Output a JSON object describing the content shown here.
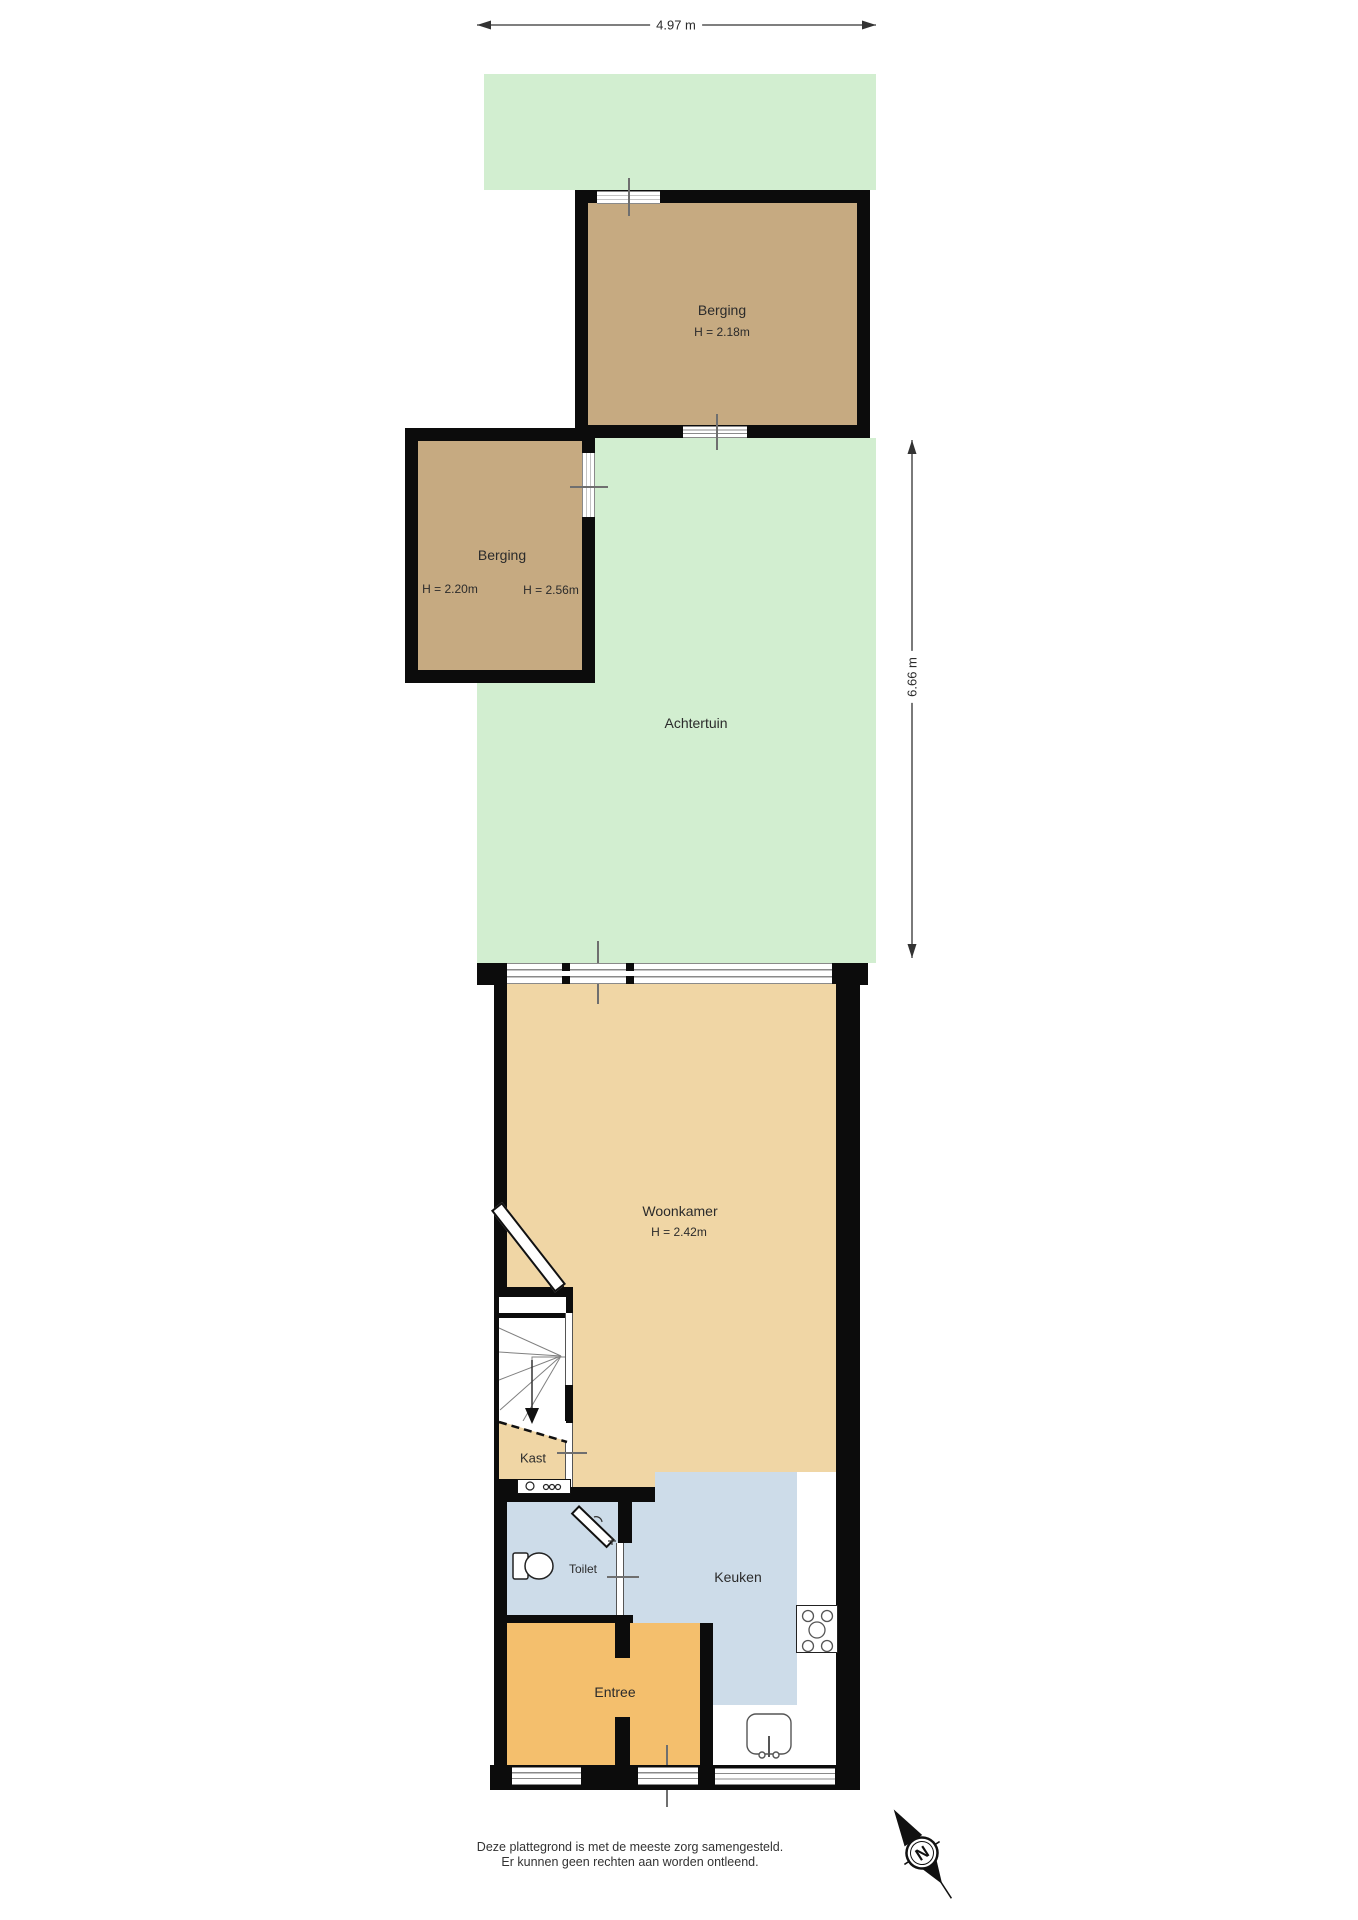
{
  "dims": {
    "width": "4.97 m",
    "depth": "6.66 m"
  },
  "rooms": {
    "berging_top": {
      "name": "Berging",
      "height": "H = 2.18m"
    },
    "berging_left": {
      "name": "Berging",
      "height_left": "H = 2.20m",
      "height_right": "H = 2.56m"
    },
    "achtertuin": {
      "name": "Achtertuin"
    },
    "woonkamer": {
      "name": "Woonkamer",
      "height": "H = 2.42m"
    },
    "kast": {
      "name": "Kast"
    },
    "toilet": {
      "name": "Toilet"
    },
    "keuken": {
      "name": "Keuken"
    },
    "entree": {
      "name": "Entree"
    }
  },
  "compass": {
    "north": "N"
  },
  "disclaimer": {
    "line1": "Deze plattegrond is met de meeste zorg samengesteld.",
    "line2": "Er kunnen geen rechten aan worden ontleend."
  },
  "colors": {
    "garden": "#d2eed0",
    "storage": "#c6aa81",
    "living": "#f0d6a5",
    "wet": "#cddce9",
    "hall": "#f4bf6d",
    "wall": "#0c0c0c",
    "glass-line": "#8a8a8a",
    "tick": "#6f6f6f",
    "text": "#2b2b2b"
  }
}
